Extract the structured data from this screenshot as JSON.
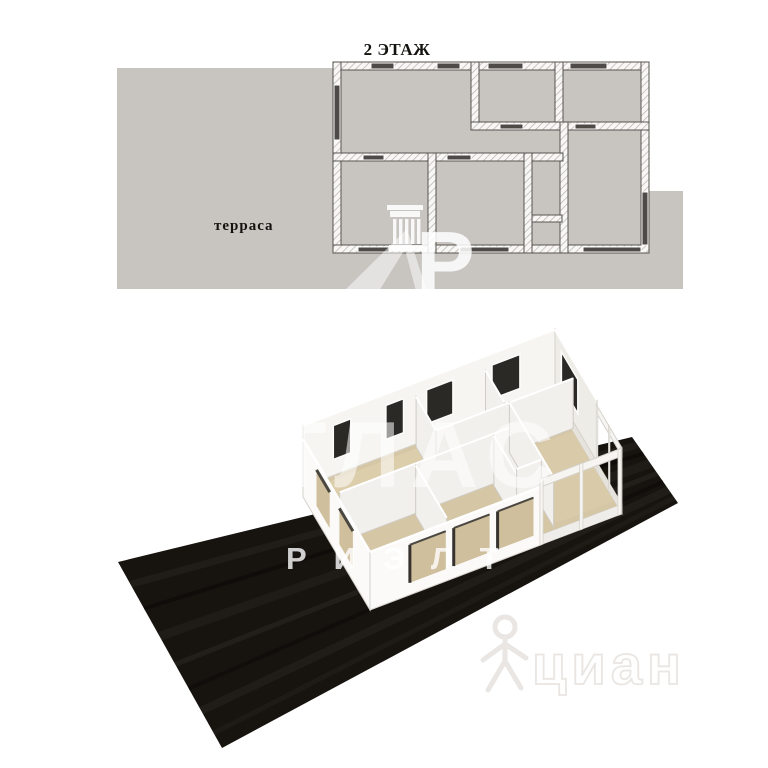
{
  "plan2d": {
    "title": "2 ЭТАЖ",
    "terrace_label": "терраса",
    "colors": {
      "ground": "#c8c4c0",
      "wall_fill": "#f8f7f5",
      "wall_hatch": "#b5b1ac",
      "wall_outline": "#57544f",
      "window": "#4d4a47",
      "label_text": "#15130f"
    }
  },
  "render3d": {
    "colors": {
      "ground": "#17130f",
      "floor": "#d5c6a5",
      "floor_light": "#dccdab",
      "floor_right": "#d9caa9",
      "wall": "#f7f5f1",
      "wall_shade": "#eeece7",
      "wall_edge": "#d5d2cc",
      "interior_wall": "#f2f0ec",
      "opening": "#2b2926",
      "panel": "#cfbf9c"
    }
  },
  "watermarks": {
    "brand_line1": "АТЛАС",
    "brand_line2": "РИЭЛТ",
    "monogram_letter": "Р",
    "portal_name": "циан",
    "colors": {
      "brand_white": "rgba(255,255,255,0.55)",
      "portal_gray": "#e9e6e3"
    }
  }
}
